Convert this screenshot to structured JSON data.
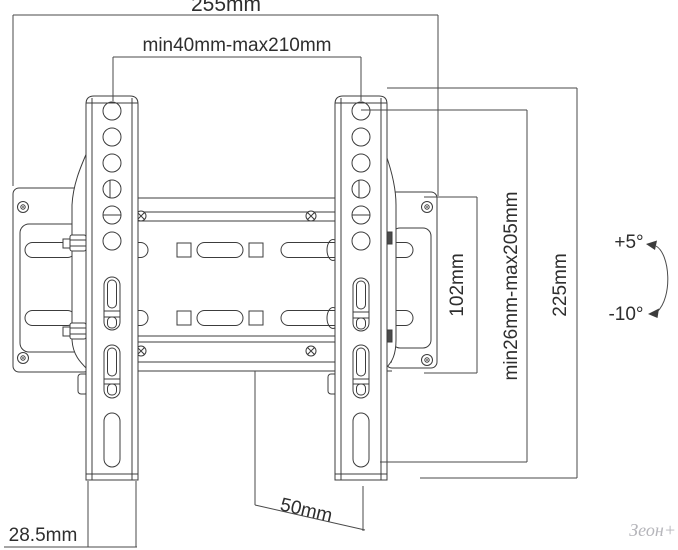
{
  "diagram": {
    "type": "technical-drawing",
    "subject": "Tilting TV wall mount bracket with dimensions",
    "labels": {
      "overall_width": "255mm",
      "hole_span_range": "min40mm-max210mm",
      "plate_height": "102mm",
      "vesa_height_range": "min26mm-max205mm",
      "bracket_height": "225mm",
      "tilt_up": "+5°",
      "tilt_down": "-10°",
      "rail_width": "28.5mm",
      "bottom_offset": "50mm",
      "watermark": "Зеон+"
    },
    "colors": {
      "line": "#3c3c3c",
      "dimension_line": "#4a4a4a",
      "text": "#2e2e2e",
      "watermark": "#b6b6bb",
      "background": "#ffffff"
    }
  }
}
